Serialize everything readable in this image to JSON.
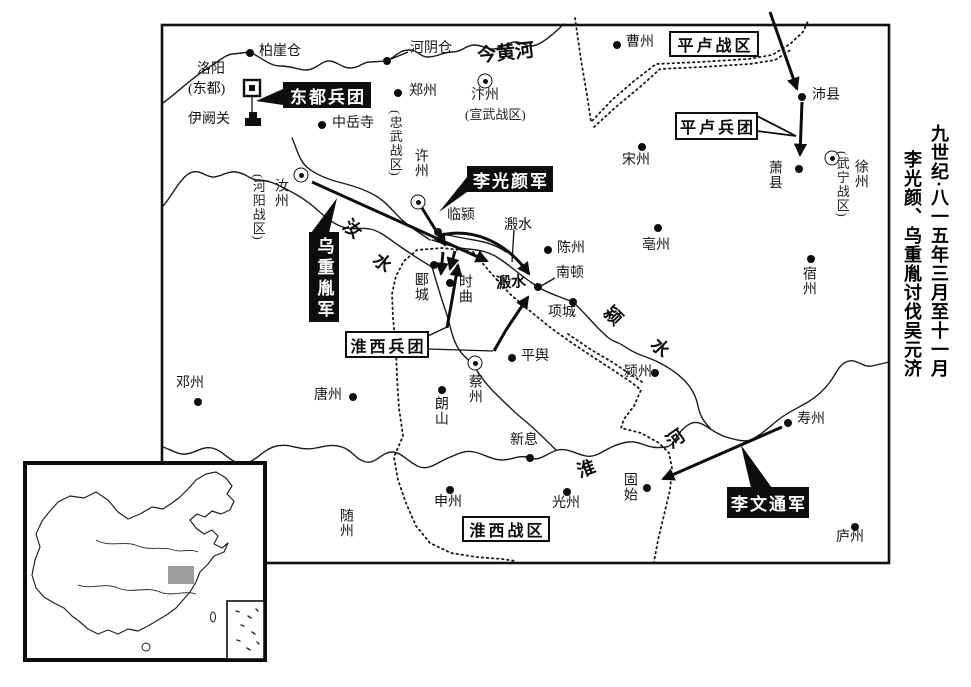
{
  "title": {
    "line1": "九世纪·八一五年三月至十一月",
    "line2": "李光颜、乌重胤讨伐吴元济"
  },
  "colors": {
    "ink": "#111111",
    "paper": "#ffffff",
    "inset_region": "#9b9b9b"
  },
  "map": {
    "cities": [
      {
        "id": "baiyacang",
        "label": "柏崖仓",
        "marker": "dot",
        "dot": [
          250,
          53
        ],
        "lpos": [
          259,
          45
        ],
        "o": "h"
      },
      {
        "id": "heyincang",
        "label": "河阴仓",
        "marker": "dot",
        "dot": [
          387,
          61
        ],
        "lpos": [
          410,
          42
        ],
        "o": "h"
      },
      {
        "id": "zhengzhou",
        "label": "郑州",
        "marker": "dot",
        "dot": [
          398,
          93
        ],
        "lpos": [
          409,
          85
        ],
        "o": "h"
      },
      {
        "id": "zhongyuesi",
        "label": "中岳寺",
        "marker": "dot",
        "dot": [
          322,
          125
        ],
        "lpos": [
          332,
          117
        ],
        "o": "h"
      },
      {
        "id": "luoyang",
        "label": "洛阳",
        "lpos": [
          197,
          63
        ],
        "o": "h"
      },
      {
        "id": "luoyang-dongdu",
        "label": "(东都)",
        "lpos": [
          188,
          83
        ],
        "o": "h"
      },
      {
        "id": "yiqueguan",
        "label": "伊阙关",
        "lpos": [
          188,
          113
        ],
        "o": "h"
      },
      {
        "id": "caozhou",
        "label": "曹州",
        "marker": "dot",
        "dot": [
          617,
          45
        ],
        "lpos": [
          626,
          36
        ],
        "o": "h"
      },
      {
        "id": "peixian",
        "label": "沛县",
        "marker": "dot",
        "dot": [
          802,
          97
        ],
        "lpos": [
          812,
          89
        ],
        "o": "h"
      },
      {
        "id": "xiaoxian",
        "label": "萧县",
        "marker": "dot",
        "dot": [
          799,
          169
        ],
        "lpos": [
          766,
          160
        ],
        "o": "v"
      },
      {
        "id": "songzhou",
        "label": "宋州",
        "marker": "dot",
        "dot": [
          642,
          147
        ],
        "lpos": [
          622,
          154
        ],
        "o": "h"
      },
      {
        "id": "suzhou",
        "label": "宿州",
        "marker": "dot",
        "dot": [
          811,
          259
        ],
        "lpos": [
          800,
          266
        ],
        "o": "v"
      },
      {
        "id": "xuzhou-wuning",
        "label": "徐州",
        "marker": "ring",
        "dot": [
          832,
          158
        ],
        "lpos": [
          852,
          159
        ],
        "o": "v"
      },
      {
        "id": "wuning-zone",
        "label": "(武宁战区)",
        "lpos": [
          835,
          151
        ],
        "o": "v",
        "cls": "sub"
      },
      {
        "id": "bianzhou",
        "label": "汴州",
        "marker": "ring",
        "dot": [
          485,
          81
        ],
        "lpos": [
          471,
          89
        ],
        "o": "h"
      },
      {
        "id": "xuanwu-zone",
        "label": "(宣武战区)",
        "lpos": [
          465,
          108
        ],
        "o": "h",
        "cls": "sub"
      },
      {
        "id": "zhongwu-zone",
        "label": "(忠武战区)",
        "lpos": [
          388,
          110
        ],
        "o": "v",
        "cls": "sub"
      },
      {
        "id": "xuzhou-chu",
        "label": "许州",
        "marker": "ring",
        "dot": [
          418,
          202
        ],
        "lpos": [
          412,
          148
        ],
        "o": "v"
      },
      {
        "id": "ruzhou",
        "label": "汝州",
        "marker": "ring",
        "dot": [
          301,
          175
        ],
        "lpos": [
          272,
          178
        ],
        "o": "v"
      },
      {
        "id": "heyang-zone",
        "label": "(河阳战区)",
        "lpos": [
          251,
          174
        ],
        "o": "v",
        "cls": "sub"
      },
      {
        "id": "linying",
        "label": "临颍",
        "marker": "dot",
        "dot": [
          438,
          232
        ],
        "lpos": [
          447,
          209
        ],
        "o": "h"
      },
      {
        "id": "chenzhou",
        "label": "陈州",
        "marker": "dot",
        "dot": [
          548,
          250
        ],
        "lpos": [
          557,
          242
        ],
        "o": "h"
      },
      {
        "id": "bozhou",
        "label": "亳州",
        "marker": "dot",
        "dot": [
          658,
          228
        ],
        "lpos": [
          642,
          239
        ],
        "o": "h"
      },
      {
        "id": "yancheng",
        "label": "郾城",
        "marker": "dot",
        "dot": [
          434,
          265
        ],
        "lpos": [
          412,
          272
        ],
        "o": "v"
      },
      {
        "id": "shiqu",
        "label": "时曲",
        "marker": "dot",
        "dot": [
          450,
          283
        ],
        "lpos": [
          456,
          274
        ],
        "o": "v"
      },
      {
        "id": "nandun",
        "label": "南顿",
        "marker": "dot",
        "dot": [
          538,
          287
        ],
        "lpos": [
          556,
          267
        ],
        "o": "h"
      },
      {
        "id": "xiangcheng",
        "label": "项城",
        "marker": "dot",
        "dot": [
          573,
          302
        ],
        "lpos": [
          548,
          306
        ],
        "o": "h"
      },
      {
        "id": "yingzhou",
        "label": "颍州",
        "marker": "dot",
        "dot": [
          655,
          373
        ],
        "lpos": [
          624,
          366
        ],
        "o": "h"
      },
      {
        "id": "pingyu",
        "label": "平舆",
        "marker": "dot",
        "dot": [
          512,
          358
        ],
        "lpos": [
          521,
          350
        ],
        "o": "h"
      },
      {
        "id": "caizhou",
        "label": "蔡州",
        "marker": "ring",
        "dot": [
          475,
          363
        ],
        "lpos": [
          466,
          374
        ],
        "o": "v"
      },
      {
        "id": "langshan",
        "label": "朗山",
        "marker": "dot",
        "dot": [
          442,
          390
        ],
        "lpos": [
          432,
          396
        ],
        "o": "v"
      },
      {
        "id": "dengzhou",
        "label": "邓州",
        "marker": "dot",
        "dot": [
          198,
          402
        ],
        "lpos": [
          176,
          377
        ],
        "o": "h"
      },
      {
        "id": "tangzhou",
        "label": "唐州",
        "marker": "dot",
        "dot": [
          353,
          397
        ],
        "lpos": [
          314,
          389
        ],
        "o": "h"
      },
      {
        "id": "xinxi",
        "label": "新息",
        "marker": "dot",
        "dot": [
          530,
          458
        ],
        "lpos": [
          510,
          434
        ],
        "o": "h"
      },
      {
        "id": "shenzhou",
        "label": "申州",
        "marker": "dot",
        "dot": [
          450,
          490
        ],
        "lpos": [
          434,
          496
        ],
        "o": "h"
      },
      {
        "id": "guangzhou",
        "label": "光州",
        "marker": "dot",
        "dot": [
          567,
          492
        ],
        "lpos": [
          552,
          497
        ],
        "o": "h"
      },
      {
        "id": "gushi",
        "label": "固始",
        "marker": "dot",
        "dot": [
          647,
          488
        ],
        "lpos": [
          621,
          472
        ],
        "o": "v"
      },
      {
        "id": "shouzhou",
        "label": "寿州",
        "marker": "dot",
        "dot": [
          788,
          423
        ],
        "lpos": [
          797,
          413
        ],
        "o": "h"
      },
      {
        "id": "luzhou",
        "label": "庐州",
        "marker": "dot",
        "dot": [
          855,
          527
        ],
        "lpos": [
          836,
          531
        ],
        "o": "h"
      },
      {
        "id": "suizhou",
        "label": "随州",
        "lpos": [
          337,
          508
        ],
        "o": "v"
      }
    ],
    "unit_labels": [
      {
        "id": "dongdu-bingtuan",
        "text": "东都兵团",
        "x": 283,
        "y": 82,
        "w": 88,
        "h": 26,
        "style": "black"
      },
      {
        "id": "liguangyan-jun",
        "text": "李光颜军",
        "x": 467,
        "y": 166,
        "w": 86,
        "h": 26,
        "style": "black"
      },
      {
        "id": "wuchongyin-jun",
        "text": "乌重胤军",
        "x": 309,
        "y": 232,
        "w": 30,
        "h": 90,
        "style": "black",
        "orient": "v"
      },
      {
        "id": "liwentong-jun",
        "text": "李文通军",
        "x": 727,
        "y": 487,
        "w": 82,
        "h": 31,
        "style": "black"
      },
      {
        "id": "pinglu-zhanqu",
        "text": "平卢战区",
        "x": 669,
        "y": 31,
        "w": 90,
        "h": 26,
        "style": "white"
      },
      {
        "id": "pinglu-bingtuan",
        "text": "平卢兵团",
        "x": 675,
        "y": 112,
        "w": 83,
        "h": 28,
        "style": "white"
      },
      {
        "id": "huaixi-bingtuan",
        "text": "淮西兵团",
        "x": 345,
        "y": 331,
        "w": 84,
        "h": 27,
        "style": "white"
      },
      {
        "id": "huaixi-zhanqu",
        "text": "淮西战区",
        "x": 462,
        "y": 516,
        "w": 88,
        "h": 26,
        "style": "white"
      }
    ],
    "river_labels": [
      {
        "id": "yellow-river-name",
        "text": "今黄河",
        "x": 477,
        "y": 38,
        "rot": -6,
        "size": 19,
        "bold": true
      },
      {
        "id": "ru-river-char-1",
        "text": "汝",
        "x": 344,
        "y": 215,
        "rot": 40,
        "size": 18,
        "bold": true
      },
      {
        "id": "ru-river-char-2",
        "text": "水",
        "x": 374,
        "y": 249,
        "rot": 40,
        "size": 18,
        "bold": true
      },
      {
        "id": "ying-river-char-1",
        "text": "颍",
        "x": 605,
        "y": 302,
        "rot": 45,
        "size": 18,
        "bold": true
      },
      {
        "id": "ying-river-char-2",
        "text": "水",
        "x": 652,
        "y": 334,
        "rot": 45,
        "size": 18,
        "bold": true
      },
      {
        "id": "huai-river-char-1",
        "text": "淮",
        "x": 577,
        "y": 455,
        "rot": -20,
        "size": 18,
        "bold": true
      },
      {
        "id": "huai-river-char-2",
        "text": "河",
        "x": 666,
        "y": 425,
        "rot": -35,
        "size": 18,
        "bold": true
      },
      {
        "id": "yinshui-town-name",
        "text": "溵水",
        "x": 496,
        "y": 271,
        "rot": -4,
        "size": 15,
        "bold": true
      },
      {
        "id": "yinshui-river-name",
        "text": "溵水",
        "x": 504,
        "y": 214,
        "rot": 0,
        "size": 14,
        "bold": false
      }
    ]
  }
}
